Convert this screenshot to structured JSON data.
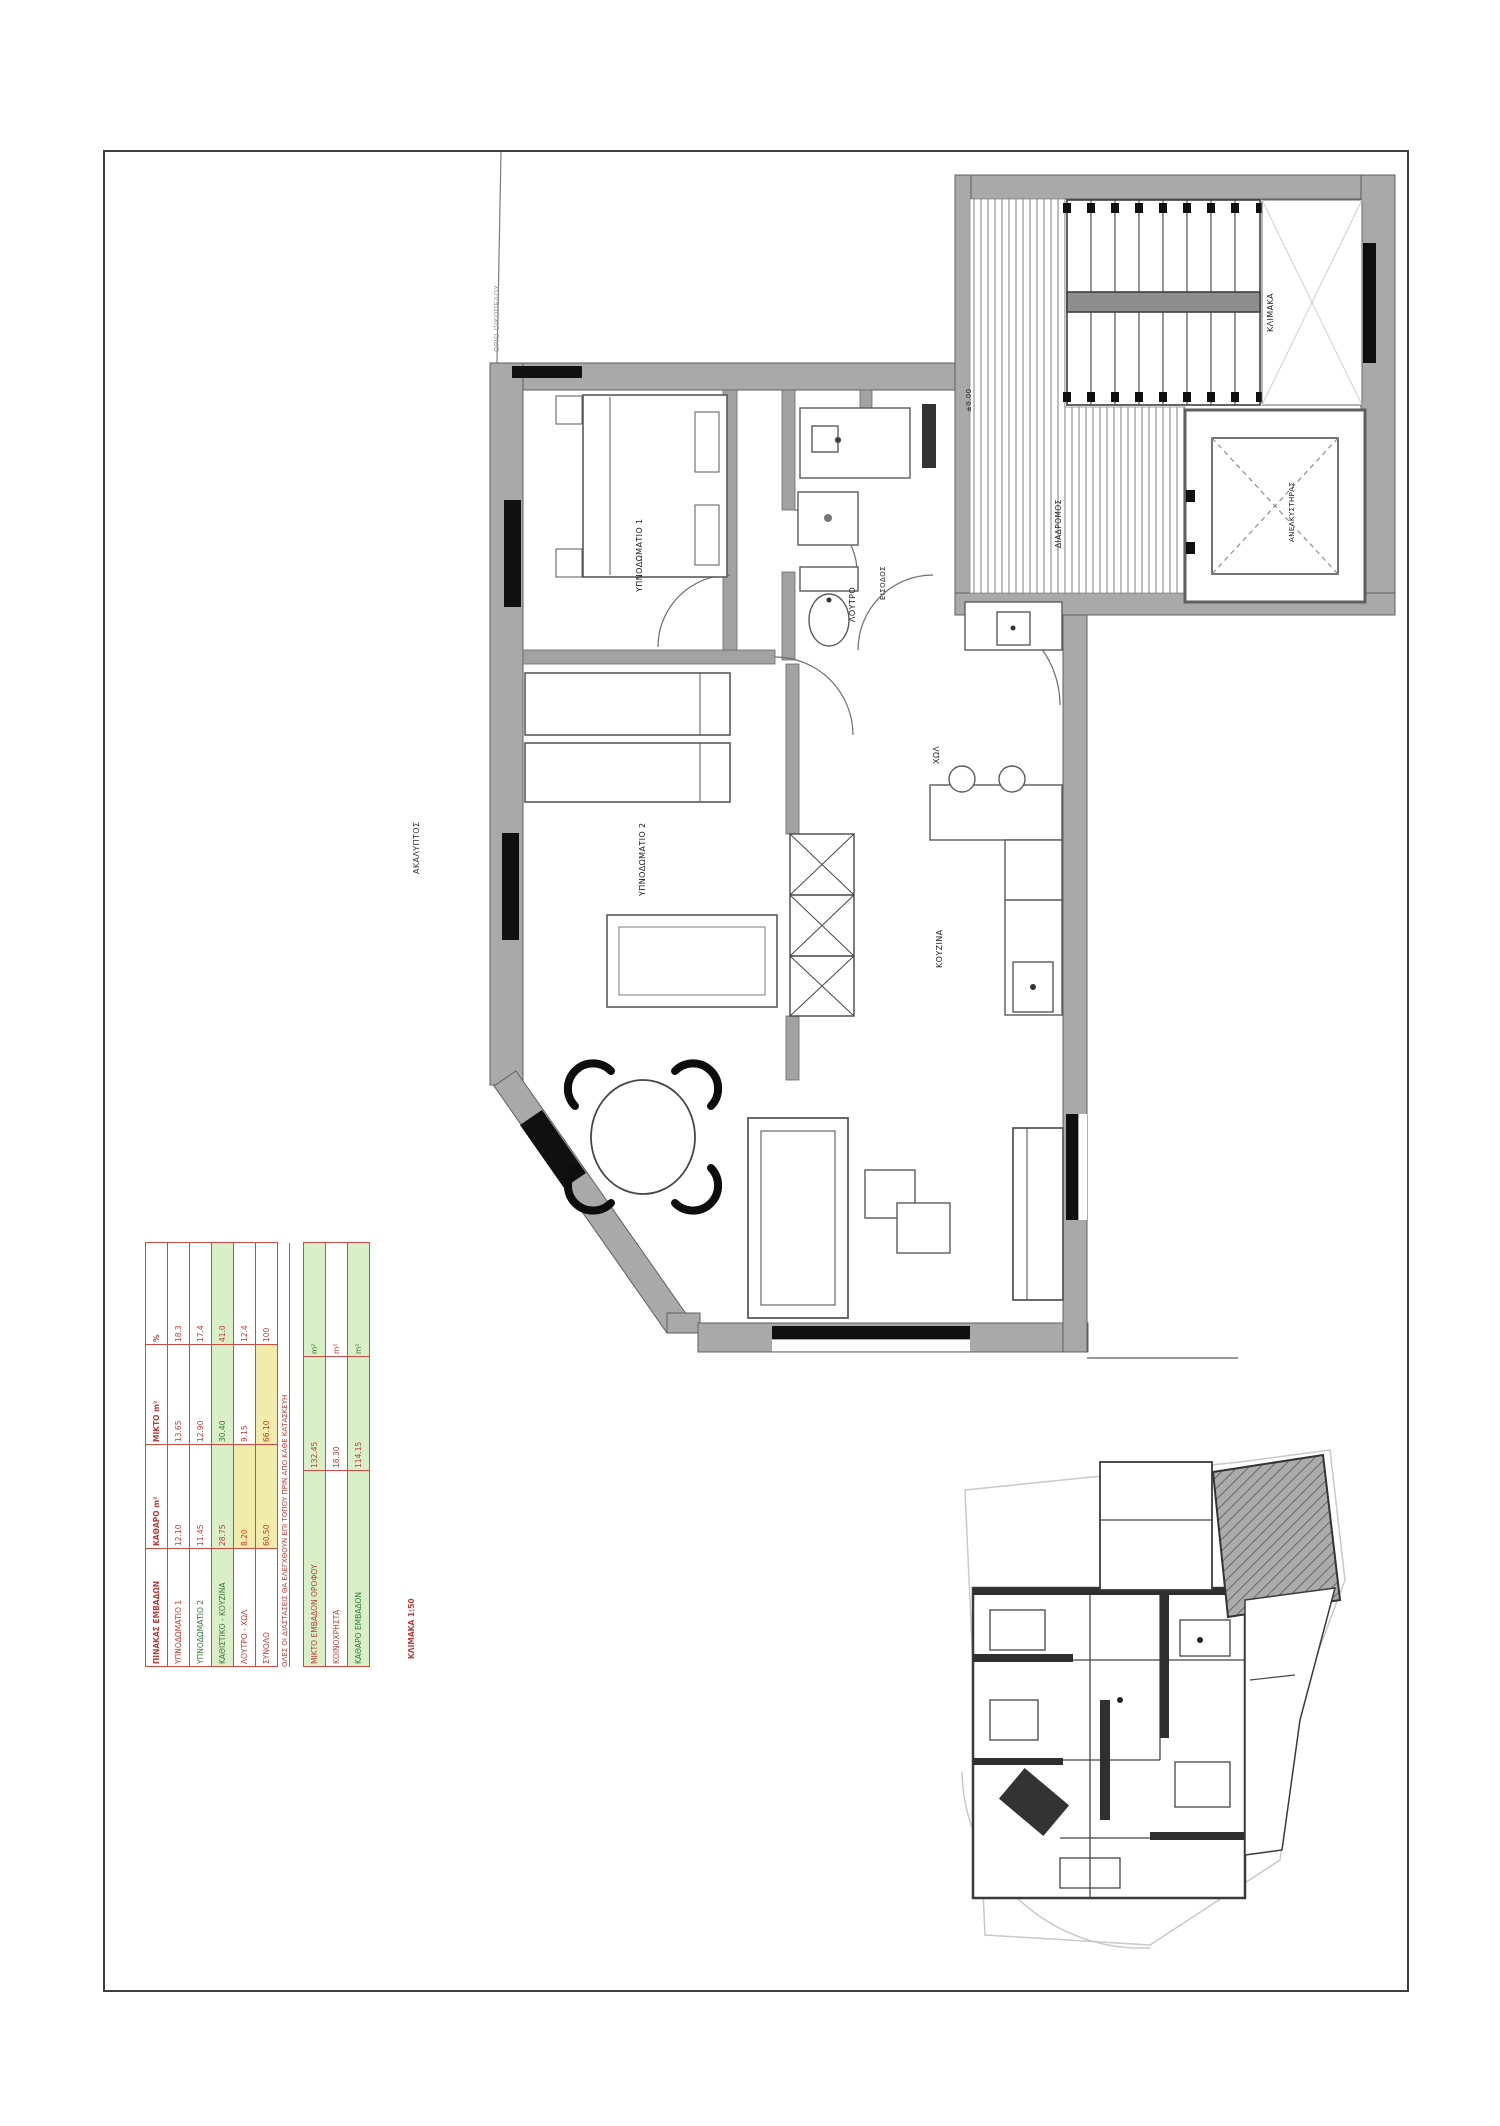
{
  "page": {
    "background": "#ffffff",
    "border_color": "#3f3f3f"
  },
  "colors": {
    "red": "#c23b33",
    "green": "#2e7d32",
    "dark": "#1f1f1f",
    "wall": "#a9a9a9",
    "black": "#101010",
    "table_green_bg": "#d9efc8",
    "table_yellow_bg": "#f2ecaa"
  },
  "plan": {
    "labels": {
      "bedroom1": "ΥΠΝΟΔΩΜΑΤΙΟ 1",
      "bedroom2": "ΥΠΝΟΔΩΜΑΤΙΟ 2",
      "bathroom": "ΛΟΥΤΡΟ",
      "hall": "ΧΩΛ",
      "kitchen": "ΚΟΥΖΙΝΑ",
      "entry": "ΕΙΣΟΔΟΣ",
      "corridor": "ΔΙΑΔΡΟΜΟΣ",
      "stairwell": "ΚΛΙΜΑΚΑ",
      "elevator": "ΑΝΕΛΚΥΣΤΗΡΑΣ",
      "landing": "±0.00",
      "open_area": "ΑΚΑΛΥΠΤΟΣ",
      "boundary": "ΟΡΙΟ ΟΙΚΟΠΕΔΟΥ"
    }
  },
  "area_table": {
    "main": {
      "header": [
        "ΠΙΝΑΚΑΣ ΕΜΒΑΔΩΝ",
        "ΚΑΘΑΡΟ m²",
        "ΜΙΚΤΟ m²",
        "%"
      ],
      "rows": [
        {
          "c": [
            "ΥΠΝΟΔΩΜΑΤΙΟ 1",
            "12.10",
            "13.65",
            "18.3"
          ],
          "bg": "",
          "yellow": [],
          "fg": [
            "red",
            "red",
            "red",
            "red"
          ]
        },
        {
          "c": [
            "ΥΠΝΟΔΩΜΑΤΙΟ 2",
            "11.45",
            "12.90",
            "17.4"
          ],
          "bg": "",
          "yellow": [],
          "fg": [
            "green",
            "red",
            "red",
            "red"
          ]
        },
        {
          "c": [
            "ΚΑΘΙΣΤΙΚΟ - ΚΟΥΖΙΝΑ",
            "28.75",
            "30.40",
            "41.0"
          ],
          "bg": "green",
          "yellow": [],
          "fg": [
            "green",
            "red",
            "green",
            "red"
          ]
        },
        {
          "c": [
            "ΛΟΥΤΡΟ - ΧΩΛ",
            "8.20",
            "9.15",
            "12.4"
          ],
          "bg": "",
          "yellow": [
            1
          ],
          "fg": [
            "red",
            "red",
            "red",
            "red"
          ]
        },
        {
          "c": [
            "ΣΥΝΟΛΟ",
            "60.50",
            "66.10",
            "100"
          ],
          "bg": "",
          "yellow": [
            1,
            2
          ],
          "fg": [
            "red",
            "red",
            "red",
            "red"
          ]
        }
      ]
    },
    "caption": "ΟΛΕΣ ΟΙ ΔΙΑΣΤΑΣΕΙΣ ΘΑ ΕΛΕΓΧΘΟΥΝ ΕΠΙ ΤΟΠΟΥ ΠΡΙΝ ΑΠΟ ΚΑΘΕ ΚΑΤΑΣΚΕΥΗ",
    "summary": {
      "rows": [
        {
          "c": [
            "ΜΙΚΤΟ ΕΜΒΑΔΟΝ ΟΡΟΦΟΥ",
            "132.45",
            "m²"
          ],
          "bg": "green",
          "yellow": [],
          "fg": [
            "red",
            "red",
            "green"
          ]
        },
        {
          "c": [
            "ΚΟΙΝΟΧΡΗΣΤΑ",
            "18.30",
            "m²"
          ],
          "bg": "",
          "yellow": [],
          "fg": [
            "red",
            "red",
            "red"
          ]
        },
        {
          "c": [
            "ΚΑΘΑΡΟ ΕΜΒΑΔΟΝ",
            "114.15",
            "m²"
          ],
          "bg": "green",
          "yellow": [],
          "fg": [
            "green",
            "red",
            "green"
          ]
        }
      ]
    },
    "scale_note": "ΚΛΙΜΑΚΑ 1:50"
  }
}
